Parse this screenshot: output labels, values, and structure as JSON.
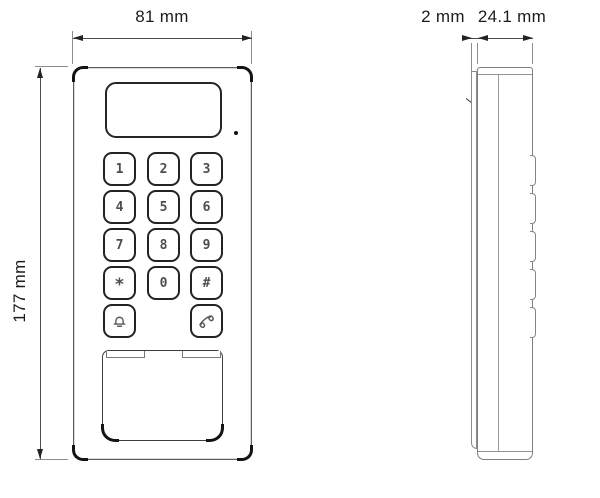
{
  "drawing": {
    "type": "technical-dimension-drawing",
    "subject": "door-station keypad unit, front and side views",
    "colors": {
      "background": "#ffffff",
      "line": "#7f7f7f",
      "accent_dark": "#1a1a1a",
      "key_text": "#4d4d4d"
    }
  },
  "dims": {
    "width": "81 mm",
    "height": "177 mm",
    "front_panel_depth": "2 mm",
    "body_depth": "24.1 mm"
  },
  "keypad": {
    "keys": [
      "1",
      "2",
      "3",
      "4",
      "5",
      "6",
      "7",
      "8",
      "9",
      "*",
      "0",
      "#"
    ],
    "special_keys": [
      {
        "name": "bell-button",
        "icon": "alarm-bell-icon"
      },
      {
        "name": "call-button",
        "icon": "phone-handset-icon"
      }
    ]
  },
  "front_view": {
    "display": "blank LCD window",
    "mic": "microphone-hole",
    "card_area": "card reader / nameplate panel"
  },
  "side_view": {
    "button_bumps": 5
  }
}
